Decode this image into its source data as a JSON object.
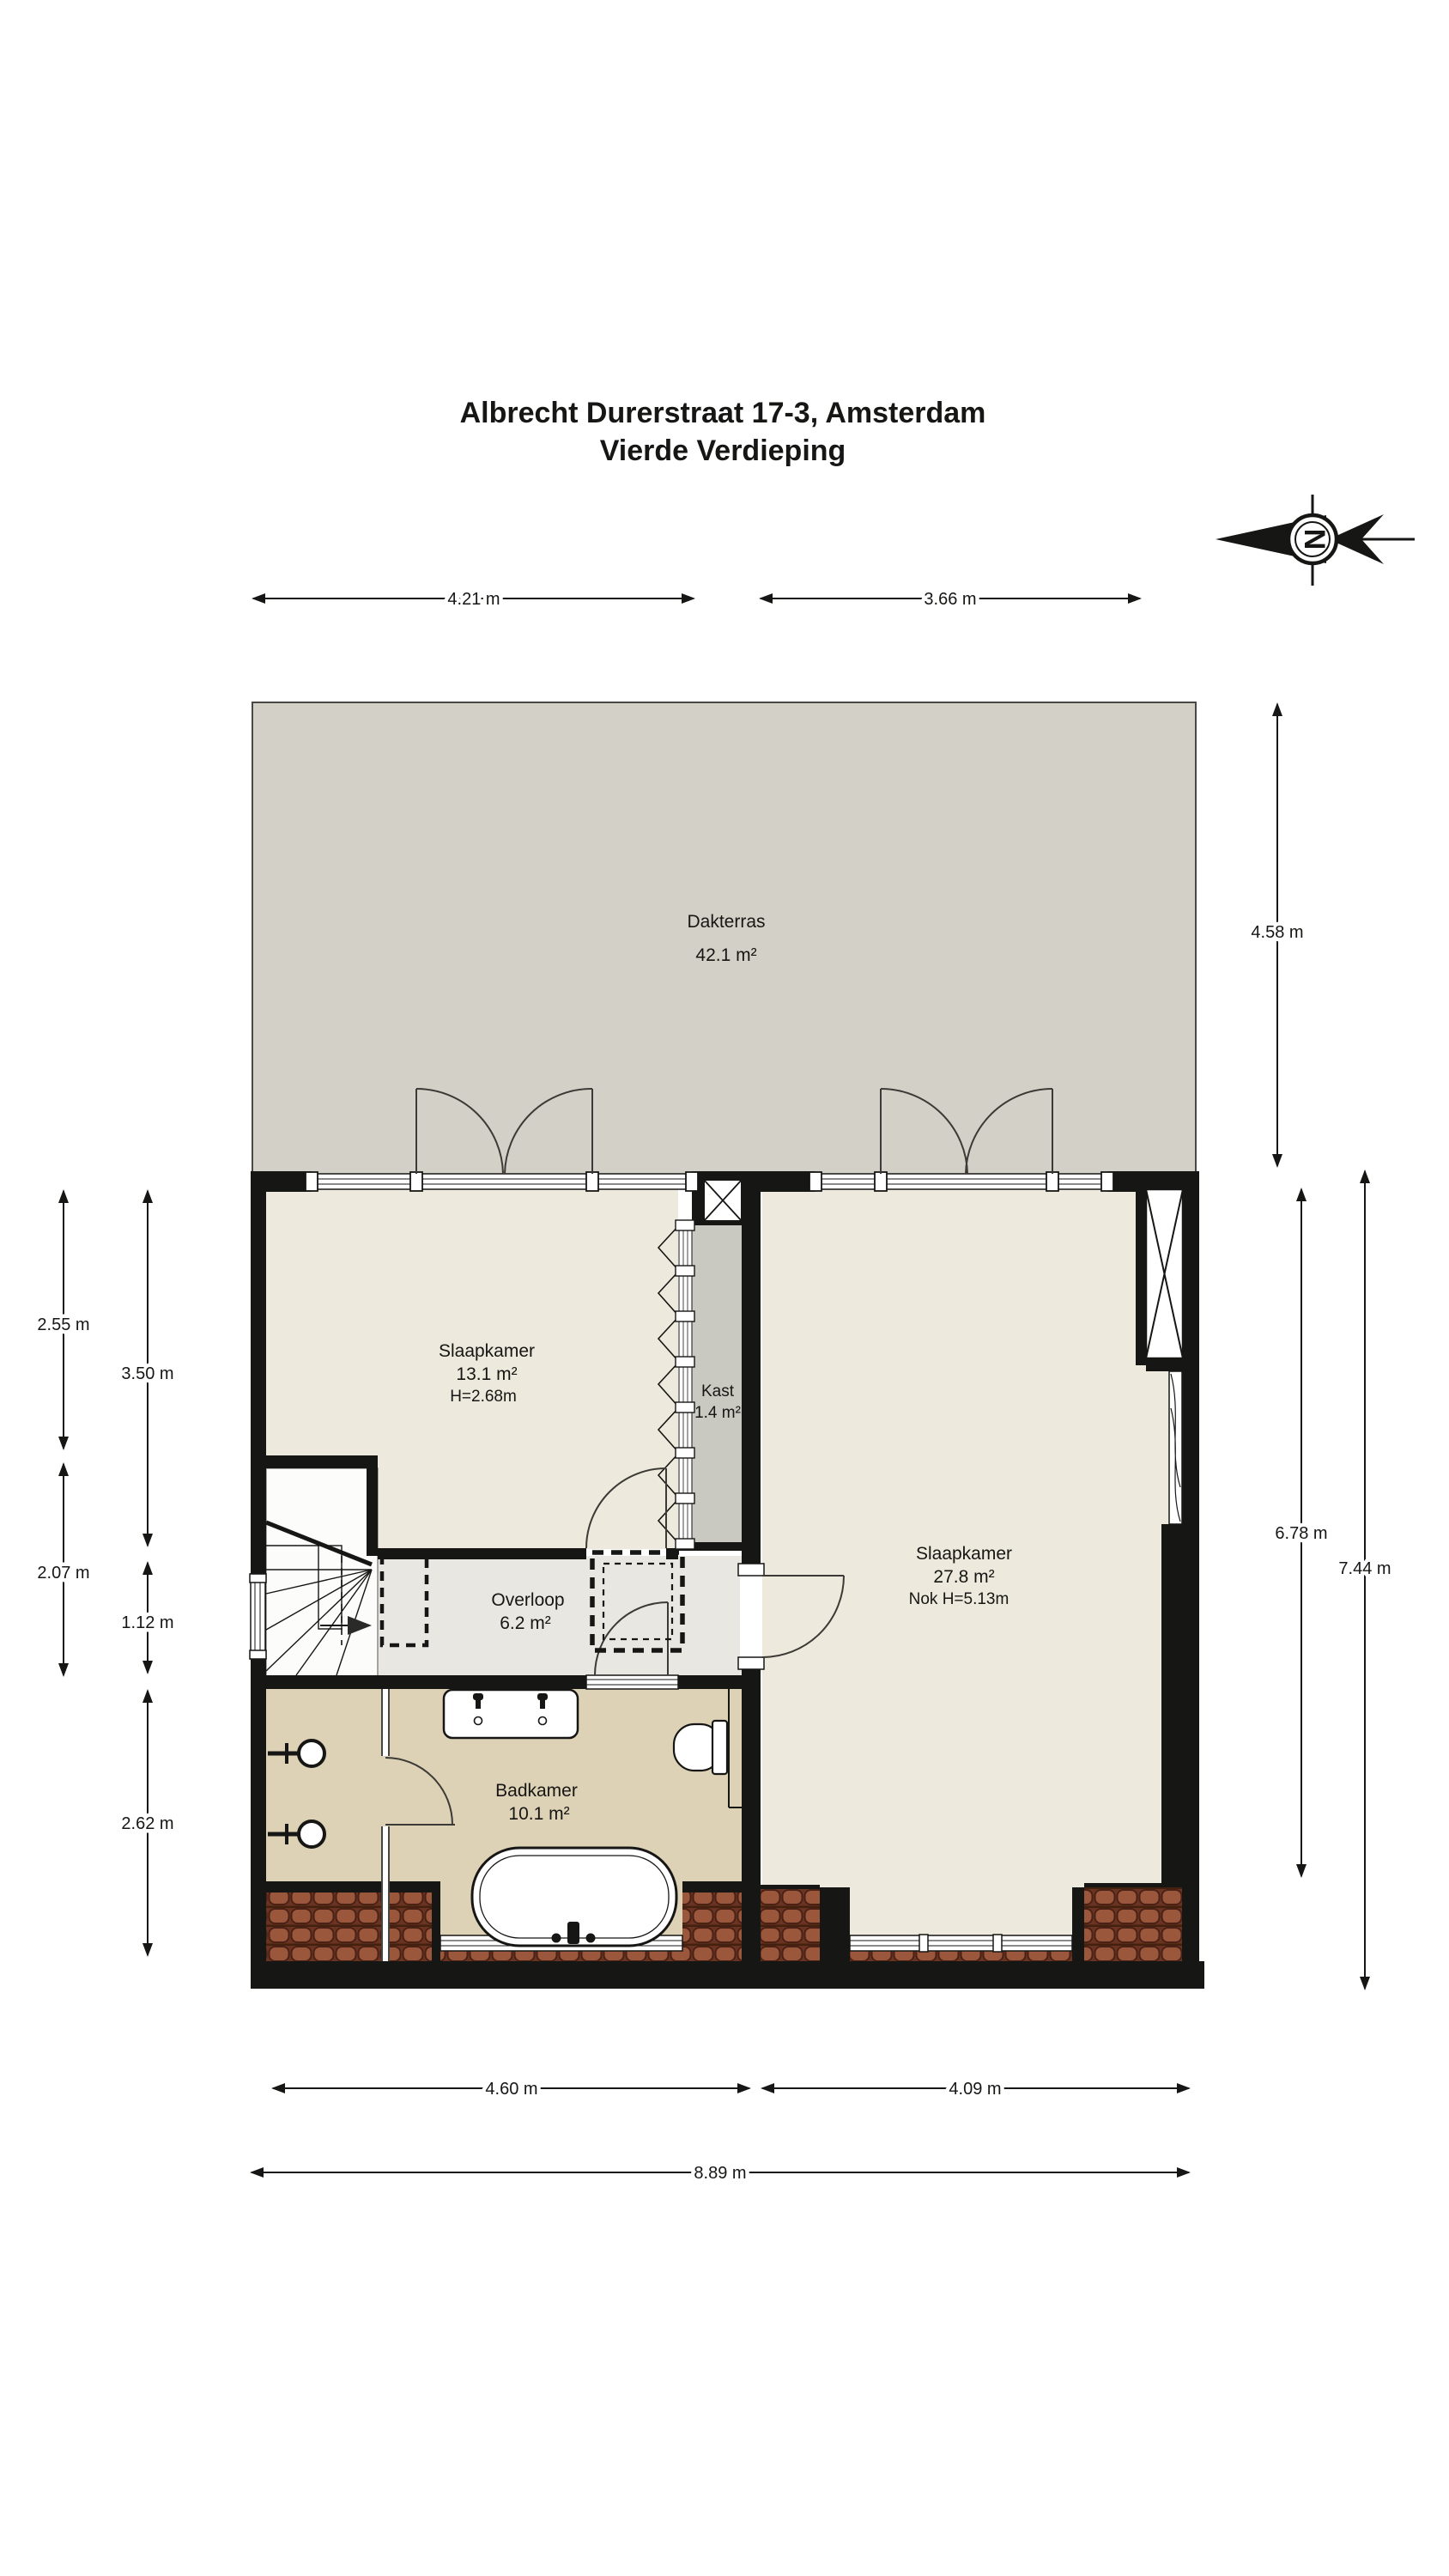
{
  "title": {
    "line1": "Albrecht Durerstraat 17-3, Amsterdam",
    "line2": "Vierde Verdieping"
  },
  "compass": {
    "letter": "N"
  },
  "rooms": {
    "dakterras": {
      "name": "Dakterras",
      "area": "42.1 m²"
    },
    "slaapkamer1": {
      "name": "Slaapkamer",
      "area": "13.1 m²",
      "height": "H=2.68m"
    },
    "kast": {
      "name": "Kast",
      "area": "1.4 m²"
    },
    "slaapkamer2": {
      "name": "Slaapkamer",
      "area": "27.8 m²",
      "height": "Nok H=5.13m"
    },
    "overloop": {
      "name": "Overloop",
      "area": "6.2 m²"
    },
    "badkamer": {
      "name": "Badkamer",
      "area": "10.1 m²"
    }
  },
  "dimensions": {
    "top_left": "4.21 m",
    "top_right": "3.66 m",
    "right_terrace": "4.58 m",
    "right_inner": "6.78 m",
    "right_outer": "7.44 m",
    "left_upper_outer": "2.55 m",
    "left_lower_outer": "2.07 m",
    "left_upper_inner": "3.50 m",
    "left_middle_inner": "1.12 m",
    "left_lower_inner": "2.62 m",
    "bottom_left": "4.60 m",
    "bottom_right": "4.09 m",
    "bottom_total": "8.89 m"
  },
  "colors": {
    "wall": "#161614",
    "terrace": "#d3d1c7",
    "bedroom_floor": "#ede9dc",
    "landing_floor": "#e9e7e1",
    "bath_floor": "#ddd1b6",
    "closet_floor": "#c9c9c2",
    "roof_tile": "#8e4f38"
  }
}
